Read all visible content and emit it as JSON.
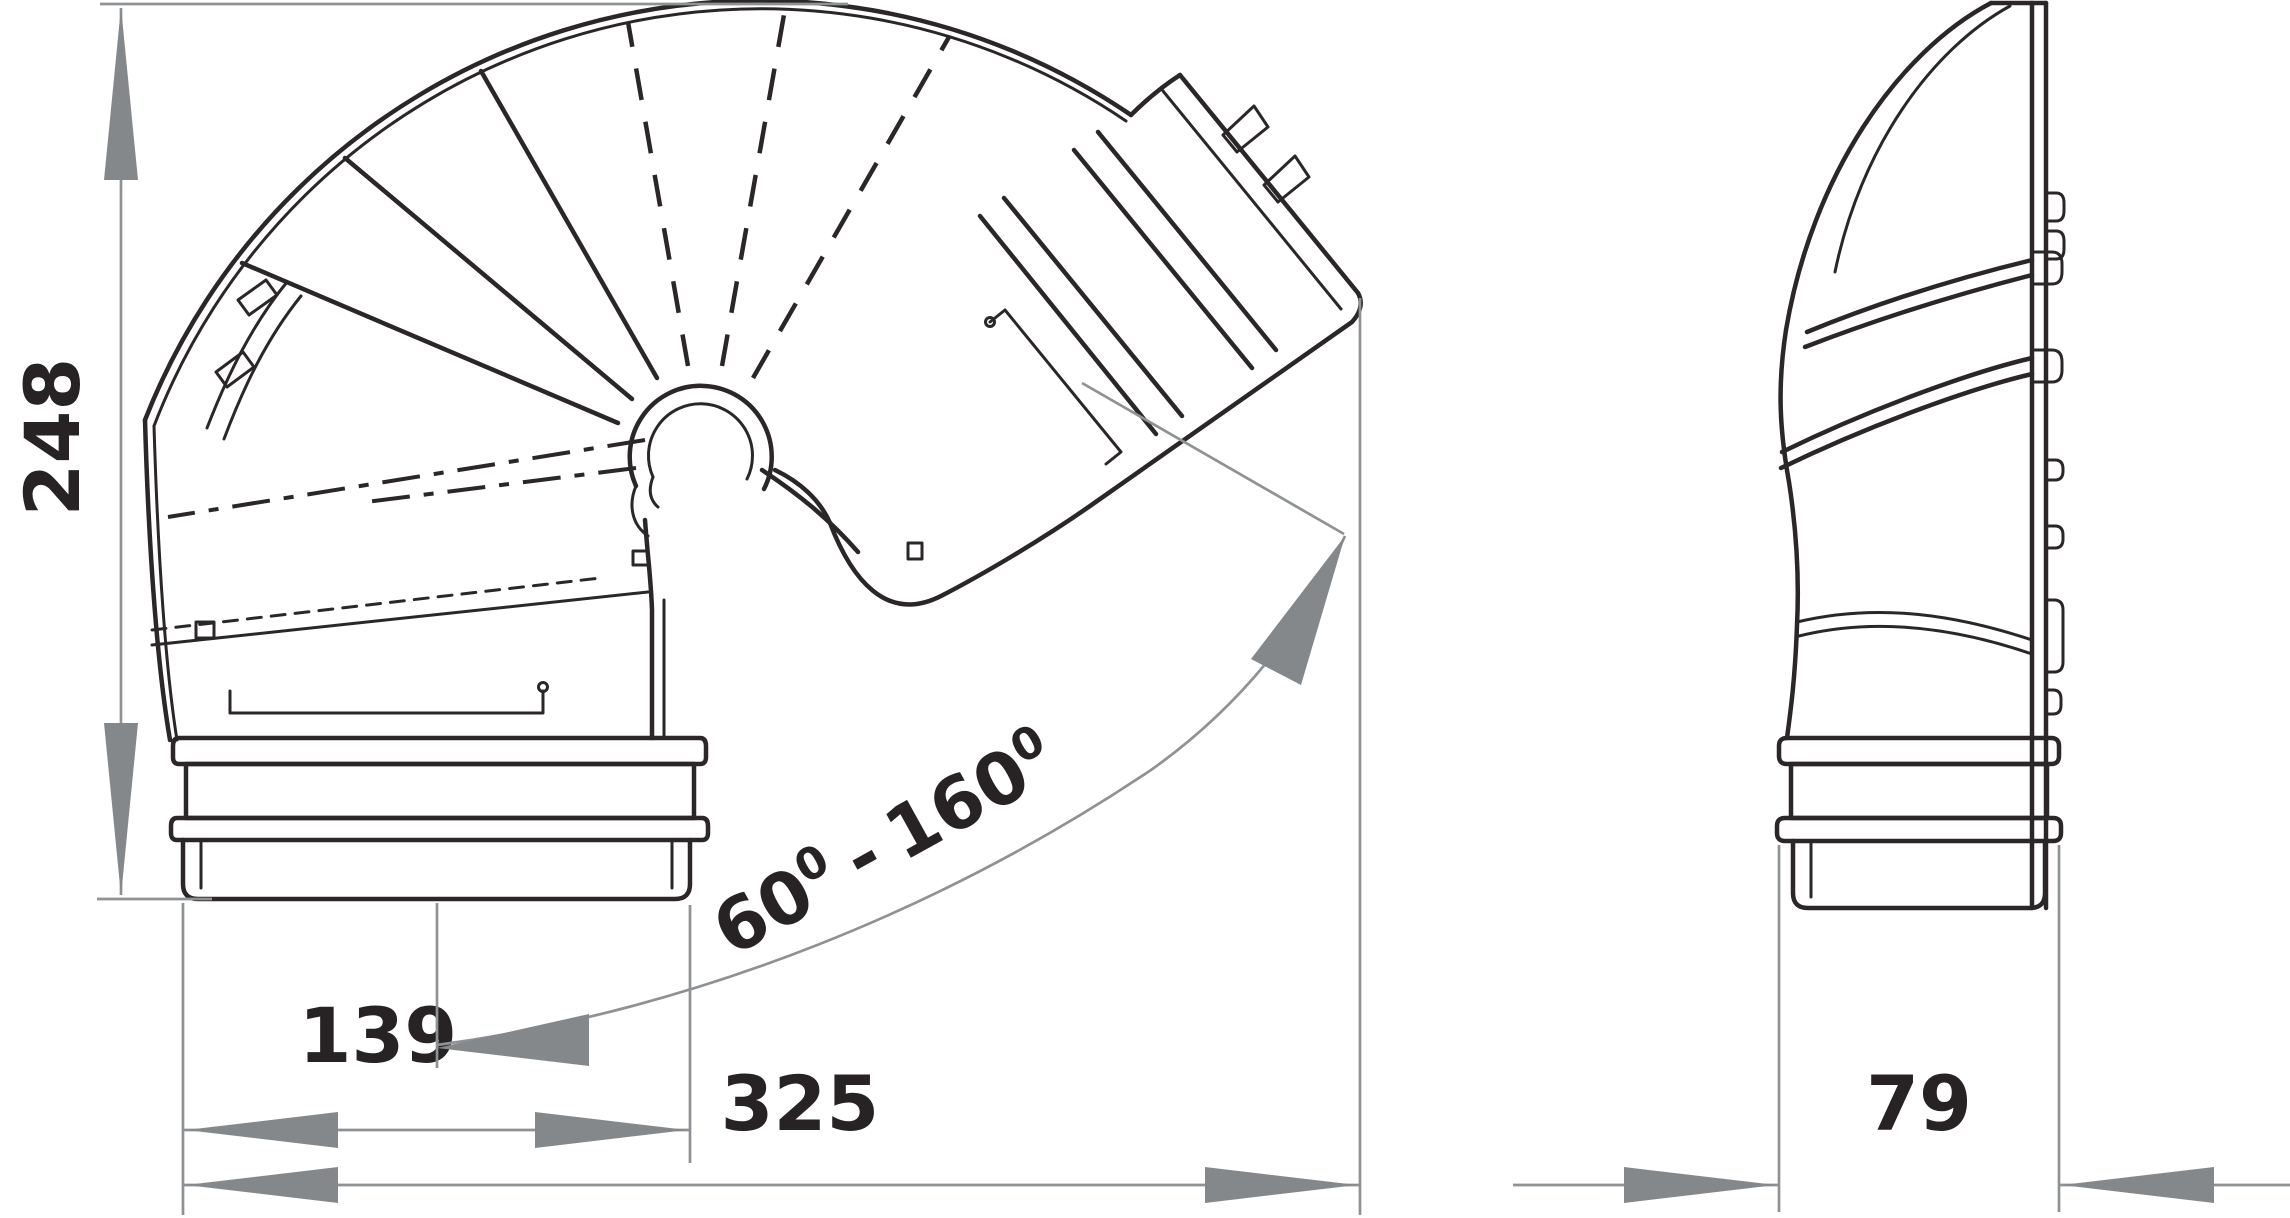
{
  "drawing": {
    "kind": "technical-dimension-drawing",
    "colors": {
      "background": "#ffffff",
      "object_line": "#2b2728",
      "dimension_line": "#8f9295",
      "dimension_arrow": "#85888b",
      "text": "#272324"
    },
    "dims": {
      "height": {
        "value": "248"
      },
      "port_width": {
        "value": "139"
      },
      "overall_width": {
        "value": "325"
      },
      "depth": {
        "value": "79"
      },
      "angle": {
        "min": "60",
        "max": "160",
        "deg": "0",
        "sep": "-",
        "display": "60° - 160°"
      }
    }
  }
}
